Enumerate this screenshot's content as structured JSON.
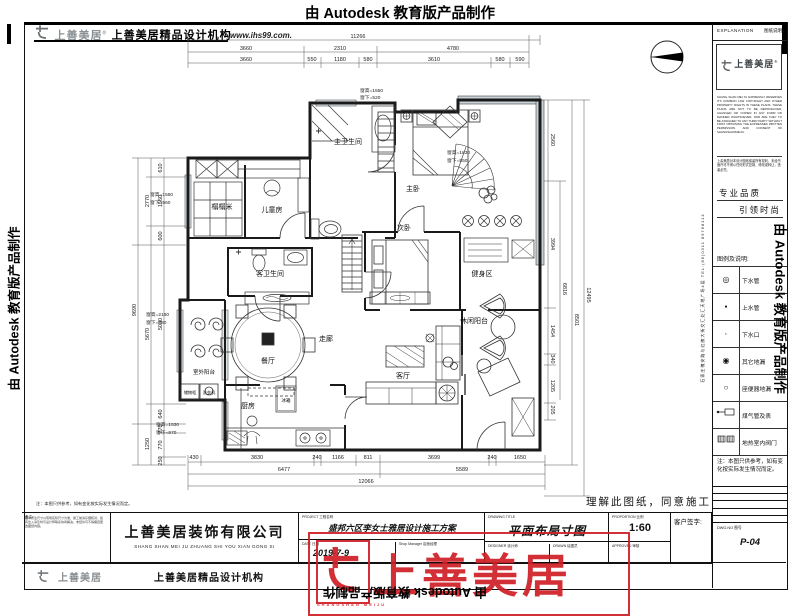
{
  "autodesk": {
    "banner": "由 Autodesk 教育版产品制作"
  },
  "header": {
    "logo_cn": "上善美居",
    "reg": "®",
    "org": "上善美居精品设计机构",
    "website": "www.ihs99.com."
  },
  "panel": {
    "explanation_en": "EXPLANATION",
    "explanation_cn": "图纸说明",
    "logo_cn": "上善美居",
    "reg": "®",
    "copyright_en": "SHANG SHAN MEI JU EXPRESSLY RESERVES ITS COMMON LAW COPYRIGHT AND OTHER PROPERTY RIGHTS IN THESE PLANS. THESE PLANS ARE NOT TO BE REPRODUCED, CHANGED OR COPIED IN ANY FORM OR MANNER WHATSOEVER, NOR ARE THEY TO BE ASSIGNED TO ANY THIRD PARTY WITHOUT FIRST OBTAINING THE EXPRESSED WRITTEN PERMISSION AND CONSENT OF SHANGSHANMEIJU.",
    "copyright_cn": "上善美居对本设计图纸保留所有权利，未经书面许可不得以任何形式复制、修改或转让，违者必究。",
    "slogan1": "专业品质",
    "slogan2": "引领时尚",
    "address_tel": "石家庄槐安路与红旗大街交汇处汇天地广场4层 TEL:(86)0311 89768114",
    "legend": {
      "title": "图例及说明:",
      "rows": [
        {
          "label": "下水管"
        },
        {
          "label": "上水管"
        },
        {
          "label": "下水口"
        },
        {
          "label": "其它地漏"
        },
        {
          "label": "座便器地漏"
        },
        {
          "label": "煤气管及表"
        },
        {
          "label": "地热室内阀门"
        }
      ]
    },
    "note": "注：本图只供参考，如有变化按实际发生情况而定。",
    "dwg_label": "DWG.NO  图号",
    "dwg_no": "P-04"
  },
  "block": {
    "remarks_label": "备注:",
    "remarks": "图中所注尺寸以现场实际尺寸为准，施工前请仔细核对，如有出入请及时与设计师联系协商解决，未经许可不得擅自更改图纸内容。",
    "company_cn": "上善美居装饰有限公司",
    "company_py": "SHANG SHAN MEI JU ZHUANG SHI YOU XIAN GONG SI",
    "project_label": "PROJECT  工程名称",
    "project_name": "盛邦六区李女士雅居设计施工方案",
    "date_label": "DATE  日期",
    "date": "2019-7-9",
    "manager_label": "Shop Manager  店面经理",
    "title_label": "DRAWING TITLE",
    "drawing_title": "平面布局寸图",
    "designer_label": "DESIGNER  设计师",
    "drawn_label": "DRAWN  绘图员",
    "proportion_label": "PROPORTION  比例",
    "scale": "1:60",
    "approved_label": "APPROVED  审核",
    "customer_label": "客户签字:",
    "agree": "理解此图纸，同意施工",
    "footer_logo_cn": "上善美居",
    "footer_org": "上善美居精品设计机构"
  },
  "wm": {
    "chars": "上善美居",
    "sub": "SHANGSHAN MEIJU"
  },
  "plan": {
    "rooms": {
      "tatami": "榻榻米",
      "kids": "儿童房",
      "mbath": "主卫生间",
      "master": "主卧",
      "second": "次卧",
      "gbath": "客卫生间",
      "corridor": "走廊",
      "dining": "餐厅",
      "living": "客厅",
      "kitchen": "厨房",
      "gym": "健身区",
      "leisure": "休闲阳台",
      "outdoor": "室外阳台",
      "storage": "储物柜",
      "washer": "洗衣机",
      "fridge": "冰箱"
    },
    "win": [
      {
        "a": "窗高=1550",
        "b": "窗下=520"
      },
      {
        "a": "窗高=1830",
        "b": "窗下=550"
      },
      {
        "a": "窗高=1550",
        "b": "窗下=960"
      },
      {
        "a": "窗高=2160",
        "b": "窗下=380"
      },
      {
        "a": "窗高=1530",
        "b": "窗下=970"
      }
    ],
    "dims": {
      "t1": [
        "11266"
      ],
      "t2": [
        "3660",
        "2310",
        "4780"
      ],
      "t3": [
        "3660",
        "550",
        "1180",
        "580",
        "3610",
        "580",
        "590"
      ],
      "lsub": [
        "610",
        "1560",
        "600",
        "5030",
        "640",
        "270",
        "770",
        "250"
      ],
      "lgrp": [
        "2770",
        "5670",
        "1250"
      ],
      "ltotal": "9690",
      "r1": [
        "2560",
        "3994",
        "1454",
        "340",
        "1205",
        "205"
      ],
      "r2": [
        "6816"
      ],
      "r3": [
        "8501"
      ],
      "r4": [
        "12495"
      ],
      "b1": [
        "430",
        "3830",
        "240",
        "1166",
        "811",
        "3699",
        "240",
        "1650"
      ],
      "b2": [
        "6477",
        "5589"
      ],
      "b3": [
        "12066"
      ]
    }
  }
}
